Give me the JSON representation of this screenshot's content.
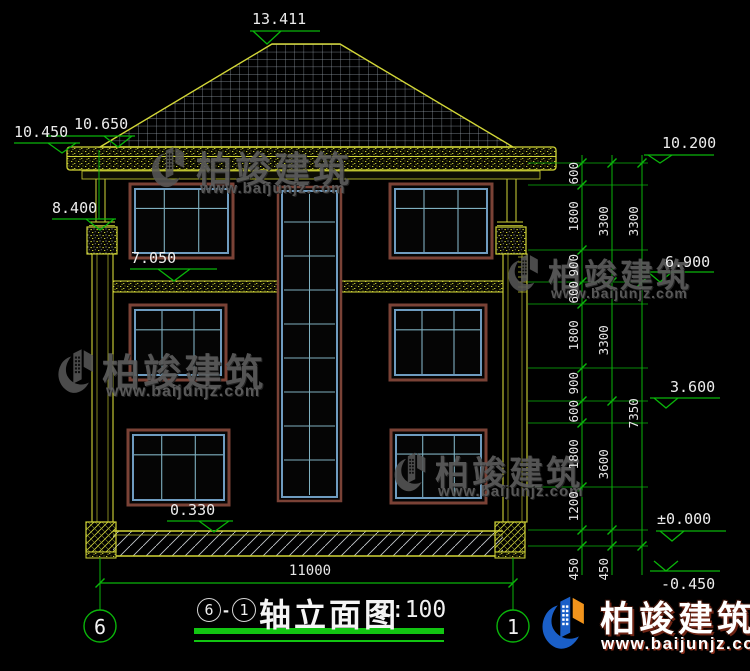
{
  "title": {
    "axis_from": "6",
    "separator": "-",
    "axis_to": "1",
    "name": "轴立面图",
    "scale": "1:100"
  },
  "axes": {
    "left": "6",
    "right": "1"
  },
  "watermark": {
    "brand": "柏竣建筑",
    "url": "www.baijunjz.com"
  },
  "logo": {
    "brand": "柏竣建筑",
    "url": "www.baijunjz.com"
  },
  "elevations": {
    "ridge": "13.411",
    "fascia": "10.650",
    "eave": "10.450",
    "capital": "8.400",
    "band": "7.050",
    "sill": "0.330",
    "right_eave": "10.200",
    "right_f3": "6.900",
    "right_f2": "3.600",
    "right_ground": "±0.000",
    "right_base": "-0.450"
  },
  "dims": {
    "total_width": "11000",
    "chain1": [
      "600",
      "1800",
      "900",
      "600",
      "1800",
      "900",
      "600",
      "1800",
      "1200",
      "450"
    ],
    "chain2": [
      "3300",
      "3300",
      "3600",
      "450"
    ],
    "chain3": [
      "3300",
      "7350"
    ]
  }
}
